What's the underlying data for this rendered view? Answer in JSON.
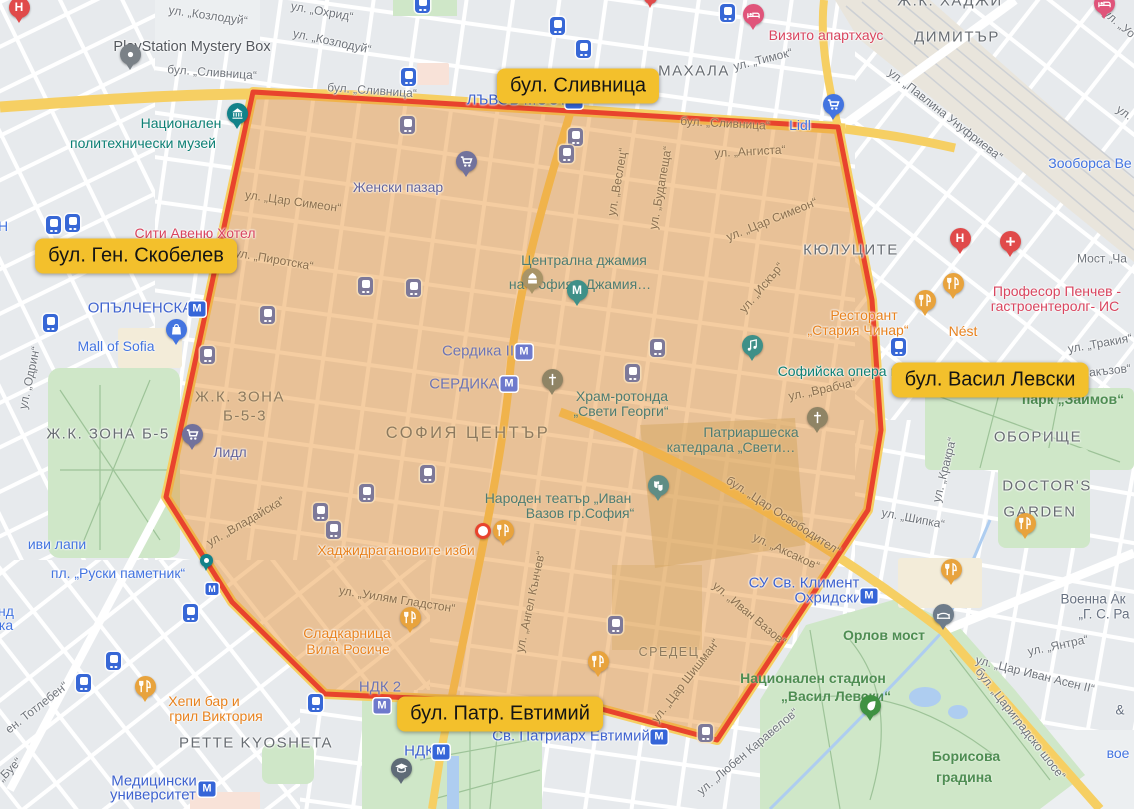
{
  "annotations": [
    {
      "text": "бул. Сливница"
    },
    {
      "text": "бул. Ген. Скобелев"
    },
    {
      "text": "бул. Васил Левски"
    },
    {
      "text": "бул. Патр. Евтимий"
    }
  ],
  "streets": {
    "s1": "ул. „Козлодуй“",
    "s2": "ул. „Охрид“",
    "s4": "бул. „Сливница“",
    "s5": "ул. „Тимок“",
    "s6": "ул. „Павлина Унуфриева“",
    "s7": "ул. „Уо",
    "s8": "ул. „Ангиста“",
    "s9": "ул. „Веслец“",
    "s10": "ул. „Будапеща“",
    "s11": "ул. „Цар Симеон“",
    "s12": "ул. „Пиротска“",
    "s13": "ул. „Искър“",
    "s14": "ул. „Тракия“",
    "s15": "ул. „Врабча“",
    "s16": "бул. „Цар Освободител“",
    "s17": "ул. „Аксаков“",
    "s18": "ул. „Иван Вазов“",
    "s19": "ул. „Цар Шишман“",
    "s20": "ул. „Ангел Кънчев“",
    "s21": "ул. „Уилям Гладстон“",
    "s22": "ул. „Владайска“",
    "s23": "ул. „Одрин“",
    "s24": "ен. Тотлебен“",
    "s25": "„Буе“",
    "s26": "ул. „Шипка“",
    "s27": "ул. „Кракра“",
    "s28": "ул. „Янтра“",
    "s29": "ул. „Цар Иван Асен II“",
    "s30": "бул. „Цариградско шосе“",
    "s31": "ул. „Любен Каравелов“",
    "s32": "Мост „Ча",
    "s33": "акъзов“",
    "s34": "ул."
  },
  "areas": {
    "a1": "МАХАЛА",
    "a2": "ДИМИТЪР",
    "a3": "Ж.К. ХАДЖИ",
    "a4": "КЮЛУЦИТЕ",
    "a5": "Ж.К. ЗОНА Б-5",
    "a6": "Ж.К. ЗОНА",
    "a7": "Б-5-3",
    "a8": "СОФИЯ ЦЕНТЪР",
    "a9": "СРЕДЕЦ",
    "a10": "ОБОРИЩЕ",
    "a11": "DOCTOR'S",
    "a12": "GARDEN",
    "a13": "PETTE KYOSHETA"
  },
  "green": {
    "g1": "парк „Заимов“",
    "g2": "Борисова",
    "g3": "градина",
    "g4": "Орлов мост",
    "g5": "Национален стадион",
    "g6": "„Васил Левски“"
  },
  "metro": {
    "m1": "ЛЪВОВ МОСТ",
    "m2": "ОПЪЛЧЕНСКА",
    "m3": "Св. Патриарх Евтимий",
    "m4": "НДК",
    "m5": "Медицински",
    "m6": "университет",
    "m7": "СУ Св. Климент",
    "m8": "Охридски",
    "m9": "Сердика II",
    "m10": "СЕРДИКА",
    "m11": "НДК 2",
    "m12": "пл. „Руски паметник“",
    "m13": "иви лапи",
    "m14": "Зооборса Ве",
    "m15": "Lidl",
    "m16": "Mall of Sofia",
    "m17": "вое",
    "m18": "Н",
    "m19": "нд",
    "m20": "ка"
  },
  "pois": {
    "t1": "Национален",
    "t2": "политехнически музей",
    "t3": "Централна джамия",
    "t4": "на София - Джамия…",
    "t5": "Храм-ротонда",
    "t6": "„Свети Георги“",
    "t7": "Патриаршеска",
    "t8": "катедрала „Свети…",
    "t9": "Софийска опера и",
    "t10": "Народен театър „Иван",
    "t11": "Вазов гр.София“",
    "r1": "Сити Авеню Хотел",
    "r2": "Визито апартхаус",
    "r3": "Професор Пенчев -",
    "r4": "гастроентеролг- ИС",
    "d1": "PlayStation Mystery Box",
    "v1": "Женски пазар",
    "v2": "Лидл",
    "o1": "Хаджидрагановите изби",
    "o2": "Сладкарница",
    "o3": "Вила Росиче",
    "o4": "Хепи бар и",
    "o5": "грил Виктория",
    "o6": "Ресторант",
    "o7": "„Стария Чинар“",
    "o8": "Nést",
    "i1": "Военна Ак",
    "i2": "„Г. С. Ра",
    "i3": "&"
  },
  "glyphs": {
    "metro": "М",
    "hospital": "H"
  },
  "colors": {
    "region_fill": "rgba(232,145,47,0.45)",
    "region_border": "#e8432d",
    "annotation_bg": "#f3c02c",
    "metro_blue": "#3565d8",
    "metro_purple": "#6e79cc",
    "road_yellow": "#f6cf63",
    "park_green": "#cfe7c8",
    "poi_orange": "#e8821e",
    "poi_red": "#d9455f",
    "poi_teal": "#12828a",
    "poi_blue": "#4374e0"
  }
}
